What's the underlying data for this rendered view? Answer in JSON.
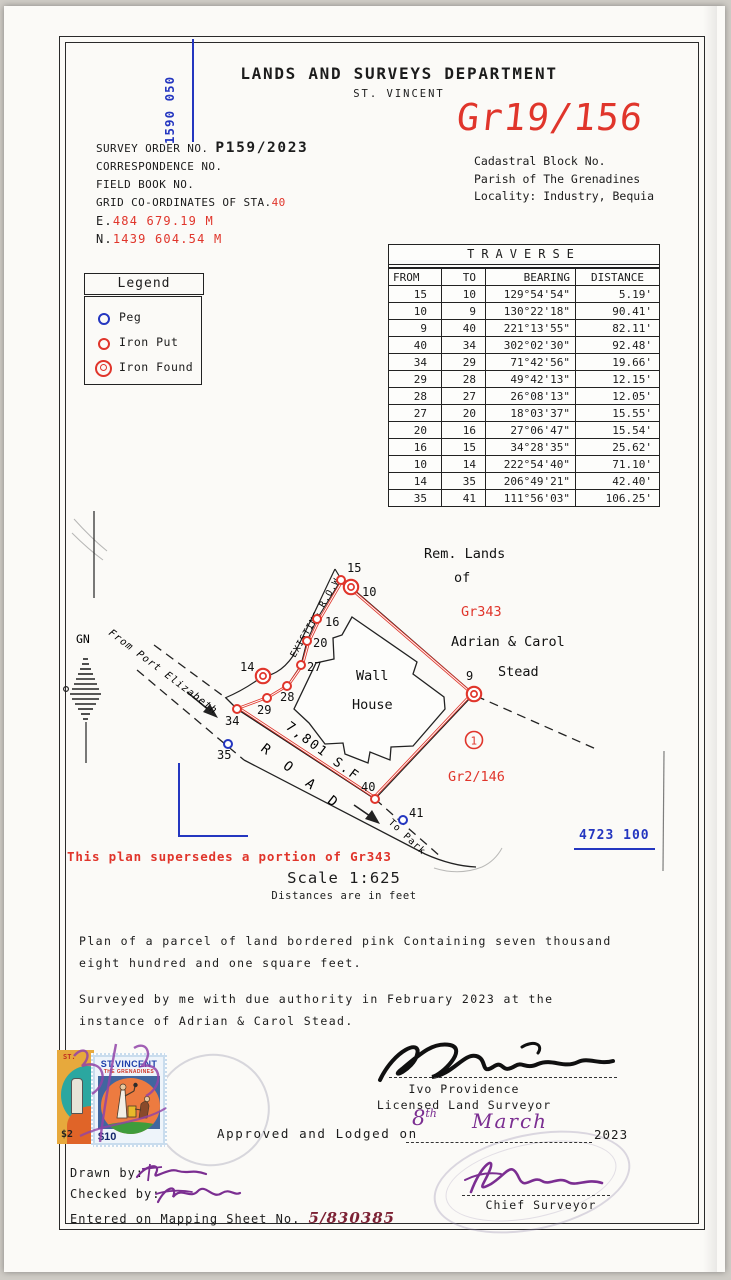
{
  "header": {
    "grid_ref_top": "1590 050",
    "title": "LANDS AND SURVEYS DEPARTMENT",
    "subtitle": "ST. VINCENT",
    "plan_number": "Gr19/156"
  },
  "survey_info": {
    "order_label": "SURVEY ORDER NO.",
    "order_value": "P159/2023",
    "correspondence_label": "CORRESPONDENCE NO.",
    "field_book_label": "FIELD BOOK NO.",
    "grid_label": "GRID CO-ORDINATES OF STA.",
    "grid_station": "40",
    "easting_label": "E.",
    "easting_value": "484 679.19 M",
    "northing_label": "N.",
    "northing_value": "1439 604.54 M"
  },
  "cadastral": {
    "block": "Cadastral Block No.",
    "parish": "Parish of The Grenadines",
    "locality": "Locality: Industry, Bequia"
  },
  "legend": {
    "title": "Legend",
    "items": [
      {
        "type": "peg",
        "label": "Peg"
      },
      {
        "type": "iron-put",
        "label": "Iron Put"
      },
      {
        "type": "iron-found",
        "label": "Iron Found"
      }
    ]
  },
  "traverse": {
    "title": "TRAVERSE",
    "columns": {
      "from": "FROM",
      "to": "TO",
      "bearing": "BEARING",
      "distance": "DISTANCE"
    },
    "rows": [
      {
        "from": "15",
        "to": "10",
        "bearing": "129°54'54\"",
        "distance": "5.19'"
      },
      {
        "from": "10",
        "to": "9",
        "bearing": "130°22'18\"",
        "distance": "90.41'"
      },
      {
        "from": "9",
        "to": "40",
        "bearing": "221°13'55\"",
        "distance": "82.11'"
      },
      {
        "from": "40",
        "to": "34",
        "bearing": "302°02'30\"",
        "distance": "92.48'"
      },
      {
        "from": "34",
        "to": "29",
        "bearing": "71°42'56\"",
        "distance": "19.66'"
      },
      {
        "from": "29",
        "to": "28",
        "bearing": "49°42'13\"",
        "distance": "12.15'"
      },
      {
        "from": "28",
        "to": "27",
        "bearing": "26°08'13\"",
        "distance": "12.05'"
      },
      {
        "from": "27",
        "to": "20",
        "bearing": "18°03'37\"",
        "distance": "15.55'"
      },
      {
        "from": "20",
        "to": "16",
        "bearing": "27°06'47\"",
        "distance": "15.54'"
      },
      {
        "from": "16",
        "to": "15",
        "bearing": "34°28'35\"",
        "distance": "25.62'"
      },
      {
        "from": "10",
        "to": "14",
        "bearing": "222°54'40\"",
        "distance": "71.10'"
      },
      {
        "from": "14",
        "to": "35",
        "bearing": "206°49'21\"",
        "distance": "42.40'"
      },
      {
        "from": "35",
        "to": "41",
        "bearing": "111°56'03\"",
        "distance": "106.25'"
      }
    ]
  },
  "map": {
    "labels": {
      "gn": "GN",
      "from_port": "From Port Elizabeth",
      "existing_row": "EXISTING  R.O.W.",
      "rem1": "Rem. Lands",
      "rem2": "of",
      "gr343": "Gr343",
      "owner1": "Adrian & Carol",
      "owner2": "Stead",
      "wall": "Wall",
      "house": "House",
      "area": "7,801 S.F",
      "road": "R O A D",
      "to_park": "To Park",
      "parcel_ref": "Gr2/146",
      "circled_no": "1",
      "grid_ref_right": "4723 100"
    },
    "points": [
      {
        "id": "15",
        "type": "iron-put",
        "x": 337,
        "y": 574,
        "lx": 343,
        "ly": 566
      },
      {
        "id": "10",
        "type": "iron-found",
        "x": 347,
        "y": 581,
        "lx": 358,
        "ly": 590
      },
      {
        "id": "16",
        "type": "iron-put",
        "x": 313,
        "y": 613,
        "lx": 321,
        "ly": 620
      },
      {
        "id": "20",
        "type": "iron-put",
        "x": 303,
        "y": 635,
        "lx": 309,
        "ly": 641
      },
      {
        "id": "27",
        "type": "iron-put",
        "x": 297,
        "y": 659,
        "lx": 303,
        "ly": 665
      },
      {
        "id": "28",
        "type": "iron-put",
        "x": 283,
        "y": 680,
        "lx": 276,
        "ly": 695
      },
      {
        "id": "29",
        "type": "iron-put",
        "x": 263,
        "y": 692,
        "lx": 253,
        "ly": 708
      },
      {
        "id": "34",
        "type": "iron-put",
        "x": 233,
        "y": 703,
        "lx": 221,
        "ly": 719
      },
      {
        "id": "14",
        "type": "iron-found",
        "x": 259,
        "y": 670,
        "lx": 236,
        "ly": 665
      },
      {
        "id": "35",
        "type": "peg",
        "x": 224,
        "y": 738,
        "lx": 213,
        "ly": 753
      },
      {
        "id": "40",
        "type": "iron-put",
        "x": 371,
        "y": 793,
        "lx": 357,
        "ly": 785
      },
      {
        "id": "41",
        "type": "peg",
        "x": 399,
        "y": 814,
        "lx": 405,
        "ly": 811
      },
      {
        "id": "9",
        "type": "iron-found",
        "x": 470,
        "y": 688,
        "lx": 462,
        "ly": 674
      }
    ]
  },
  "notes": {
    "supersede": "This plan supersedes a portion of Gr343",
    "scale": "Scale 1:625",
    "scale_sub": "Distances are in feet",
    "para1a": "Plan of a parcel of land bordered pink Containing seven thousand",
    "para1b": "eight hundred and one square feet.",
    "para2a": "Surveyed by me with due authority in February 2023 at the",
    "para2b": "instance of Adrian & Carol Stead."
  },
  "signatures": {
    "surveyor_name": "Ivo Providence",
    "surveyor_title": "Licensed Land Surveyor",
    "approved_prefix": "Approved and Lodged on",
    "approved_day": "8",
    "approved_day_suffix": "th",
    "approved_month": "March",
    "approved_year": "2023",
    "chief_title": "Chief Surveyor"
  },
  "footer": {
    "drawn_label": "Drawn by:",
    "checked_label": "Checked by:",
    "entered_label": "Entered on Mapping Sheet No.",
    "entered_value": "5/830385"
  },
  "stamps": {
    "s2_country": "ST.",
    "s2_value": "$2",
    "s10_country": "ST.VINCENT",
    "s10_sub": "THE GRENADINES",
    "s10_value": "$10"
  },
  "colors": {
    "ink_red": "#e0352b",
    "ink_blue": "#2436c0",
    "ink_purple": "#7b2e91",
    "ink_black": "#1c1c1c"
  }
}
